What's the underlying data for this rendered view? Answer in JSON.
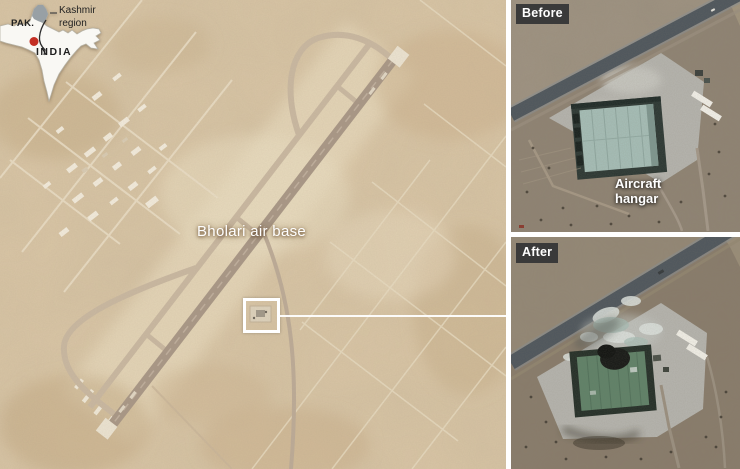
{
  "main": {
    "airbase_label": "Bholari air base",
    "inset_map": {
      "pakistan_label": "PAK.",
      "india_label": "INDIA",
      "kashmir_label": "Kashmir region"
    }
  },
  "before_panel": {
    "badge": "Before",
    "hangar_label": "Aircraft hangar"
  },
  "after_panel": {
    "badge": "After"
  },
  "colors": {
    "desert_sand": "#d9c6a6",
    "terrain_brown": "#8d8070",
    "road_gray": "#4d555c",
    "apron_gray": "#b6b5af",
    "hangar_roof_before": "#a6bfb8",
    "hangar_roof_after": "#5e8167",
    "badge_bg": "#3a3a3a",
    "badge_text": "#ffffff",
    "annotation_white": "#ffffff",
    "marker_red": "#c42f24",
    "kashmir_gray": "#98a0a5",
    "map_white": "#f9f8f4"
  }
}
